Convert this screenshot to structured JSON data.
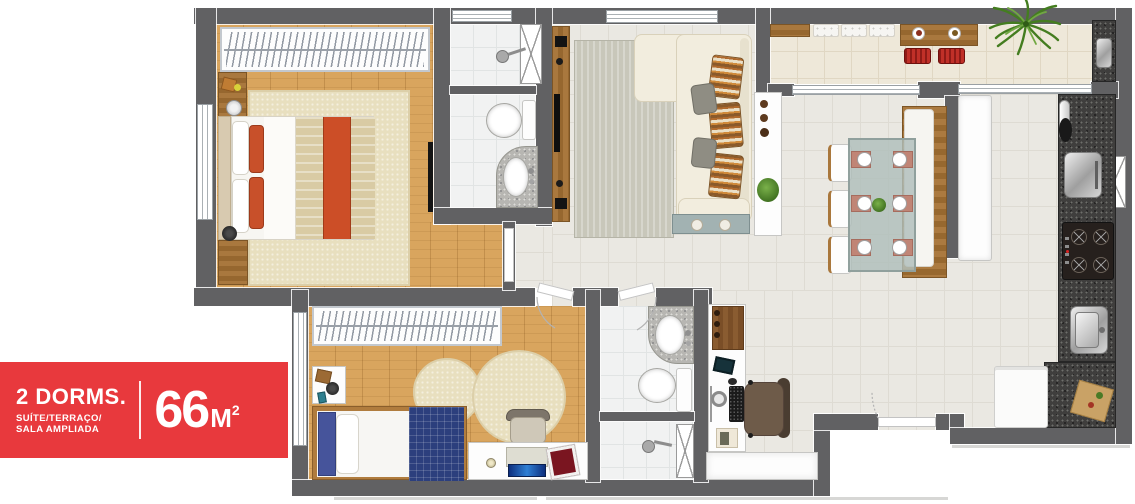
{
  "badge": {
    "title": "2 DORMS.",
    "subtitle_line1": "SUÍTE/TERRAÇO/",
    "subtitle_line2": "SALA AMPLIADA",
    "area_number": "66",
    "area_unit": "M",
    "area_exponent": "2"
  },
  "palette": {
    "badge_red": "#e8393d",
    "wall_gray": "#616163",
    "wood_floor": "#d9a55e",
    "tile_floor": "#eae8e2",
    "terrace_floor": "#eee8d9",
    "bath_tile": "#f1f2f2",
    "granite_dark": "#3f3e3d",
    "granite_light": "#b7b6b2",
    "rug_beige": "#e8dfbf",
    "rug_gray": "#c8c7ba",
    "sofa_cream": "#f2edde",
    "accent_orange": "#cc4e27",
    "bed_navy": "#2c3f7d",
    "stool_red": "#c03028",
    "plant_green": "#4a8323"
  }
}
